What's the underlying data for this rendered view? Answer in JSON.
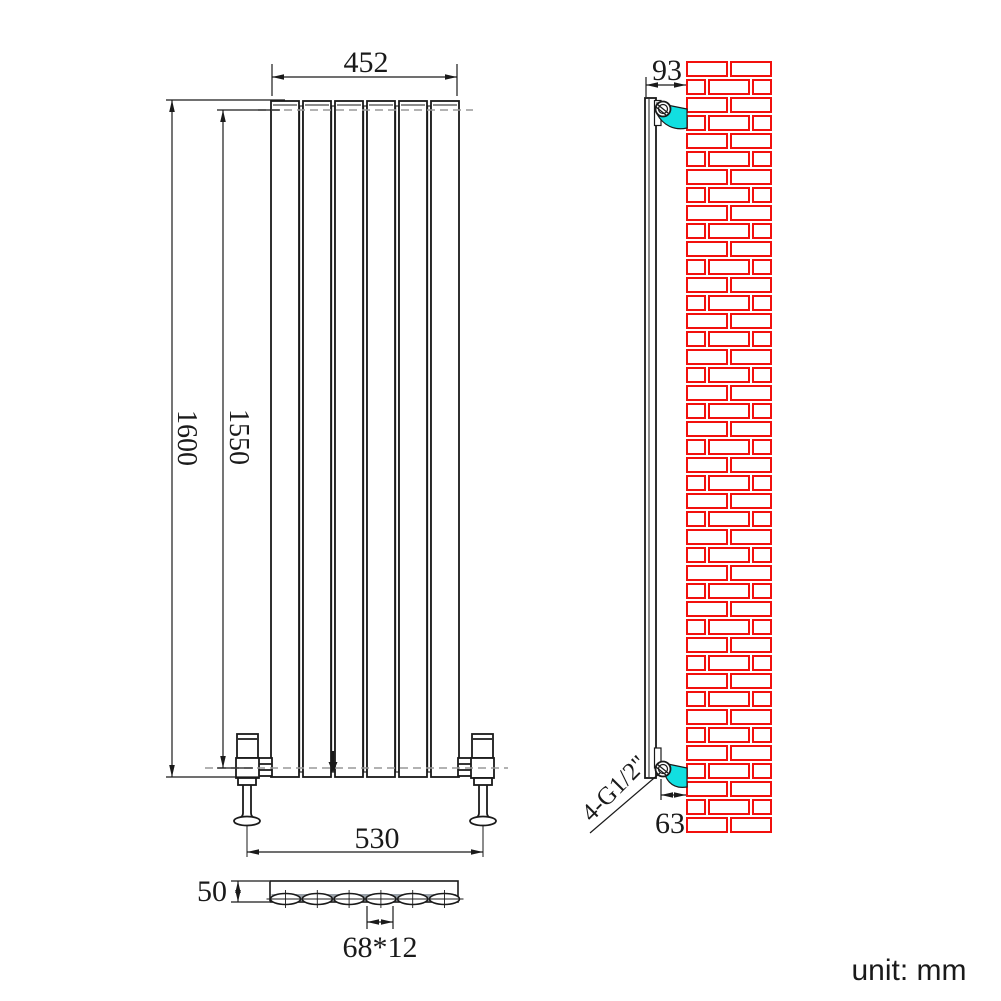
{
  "drawing": {
    "unit_label": "unit: mm",
    "dimensions": {
      "front_width": "452",
      "overall_height": "1600",
      "connection_height": "1550",
      "valve_spacing": "530",
      "depth": "50",
      "tube_size": "68*12"
    },
    "side": {
      "wall_offset": "93",
      "bottom_offset": "63",
      "thread_label": "4-G1/2\""
    },
    "colors": {
      "line": "#1a1a1a",
      "centerline": "#999999",
      "brick_red": "#f2100d",
      "bracket_cyan": "#12dfe0",
      "section_grey": "#98a0a8",
      "background": "#ffffff"
    }
  }
}
